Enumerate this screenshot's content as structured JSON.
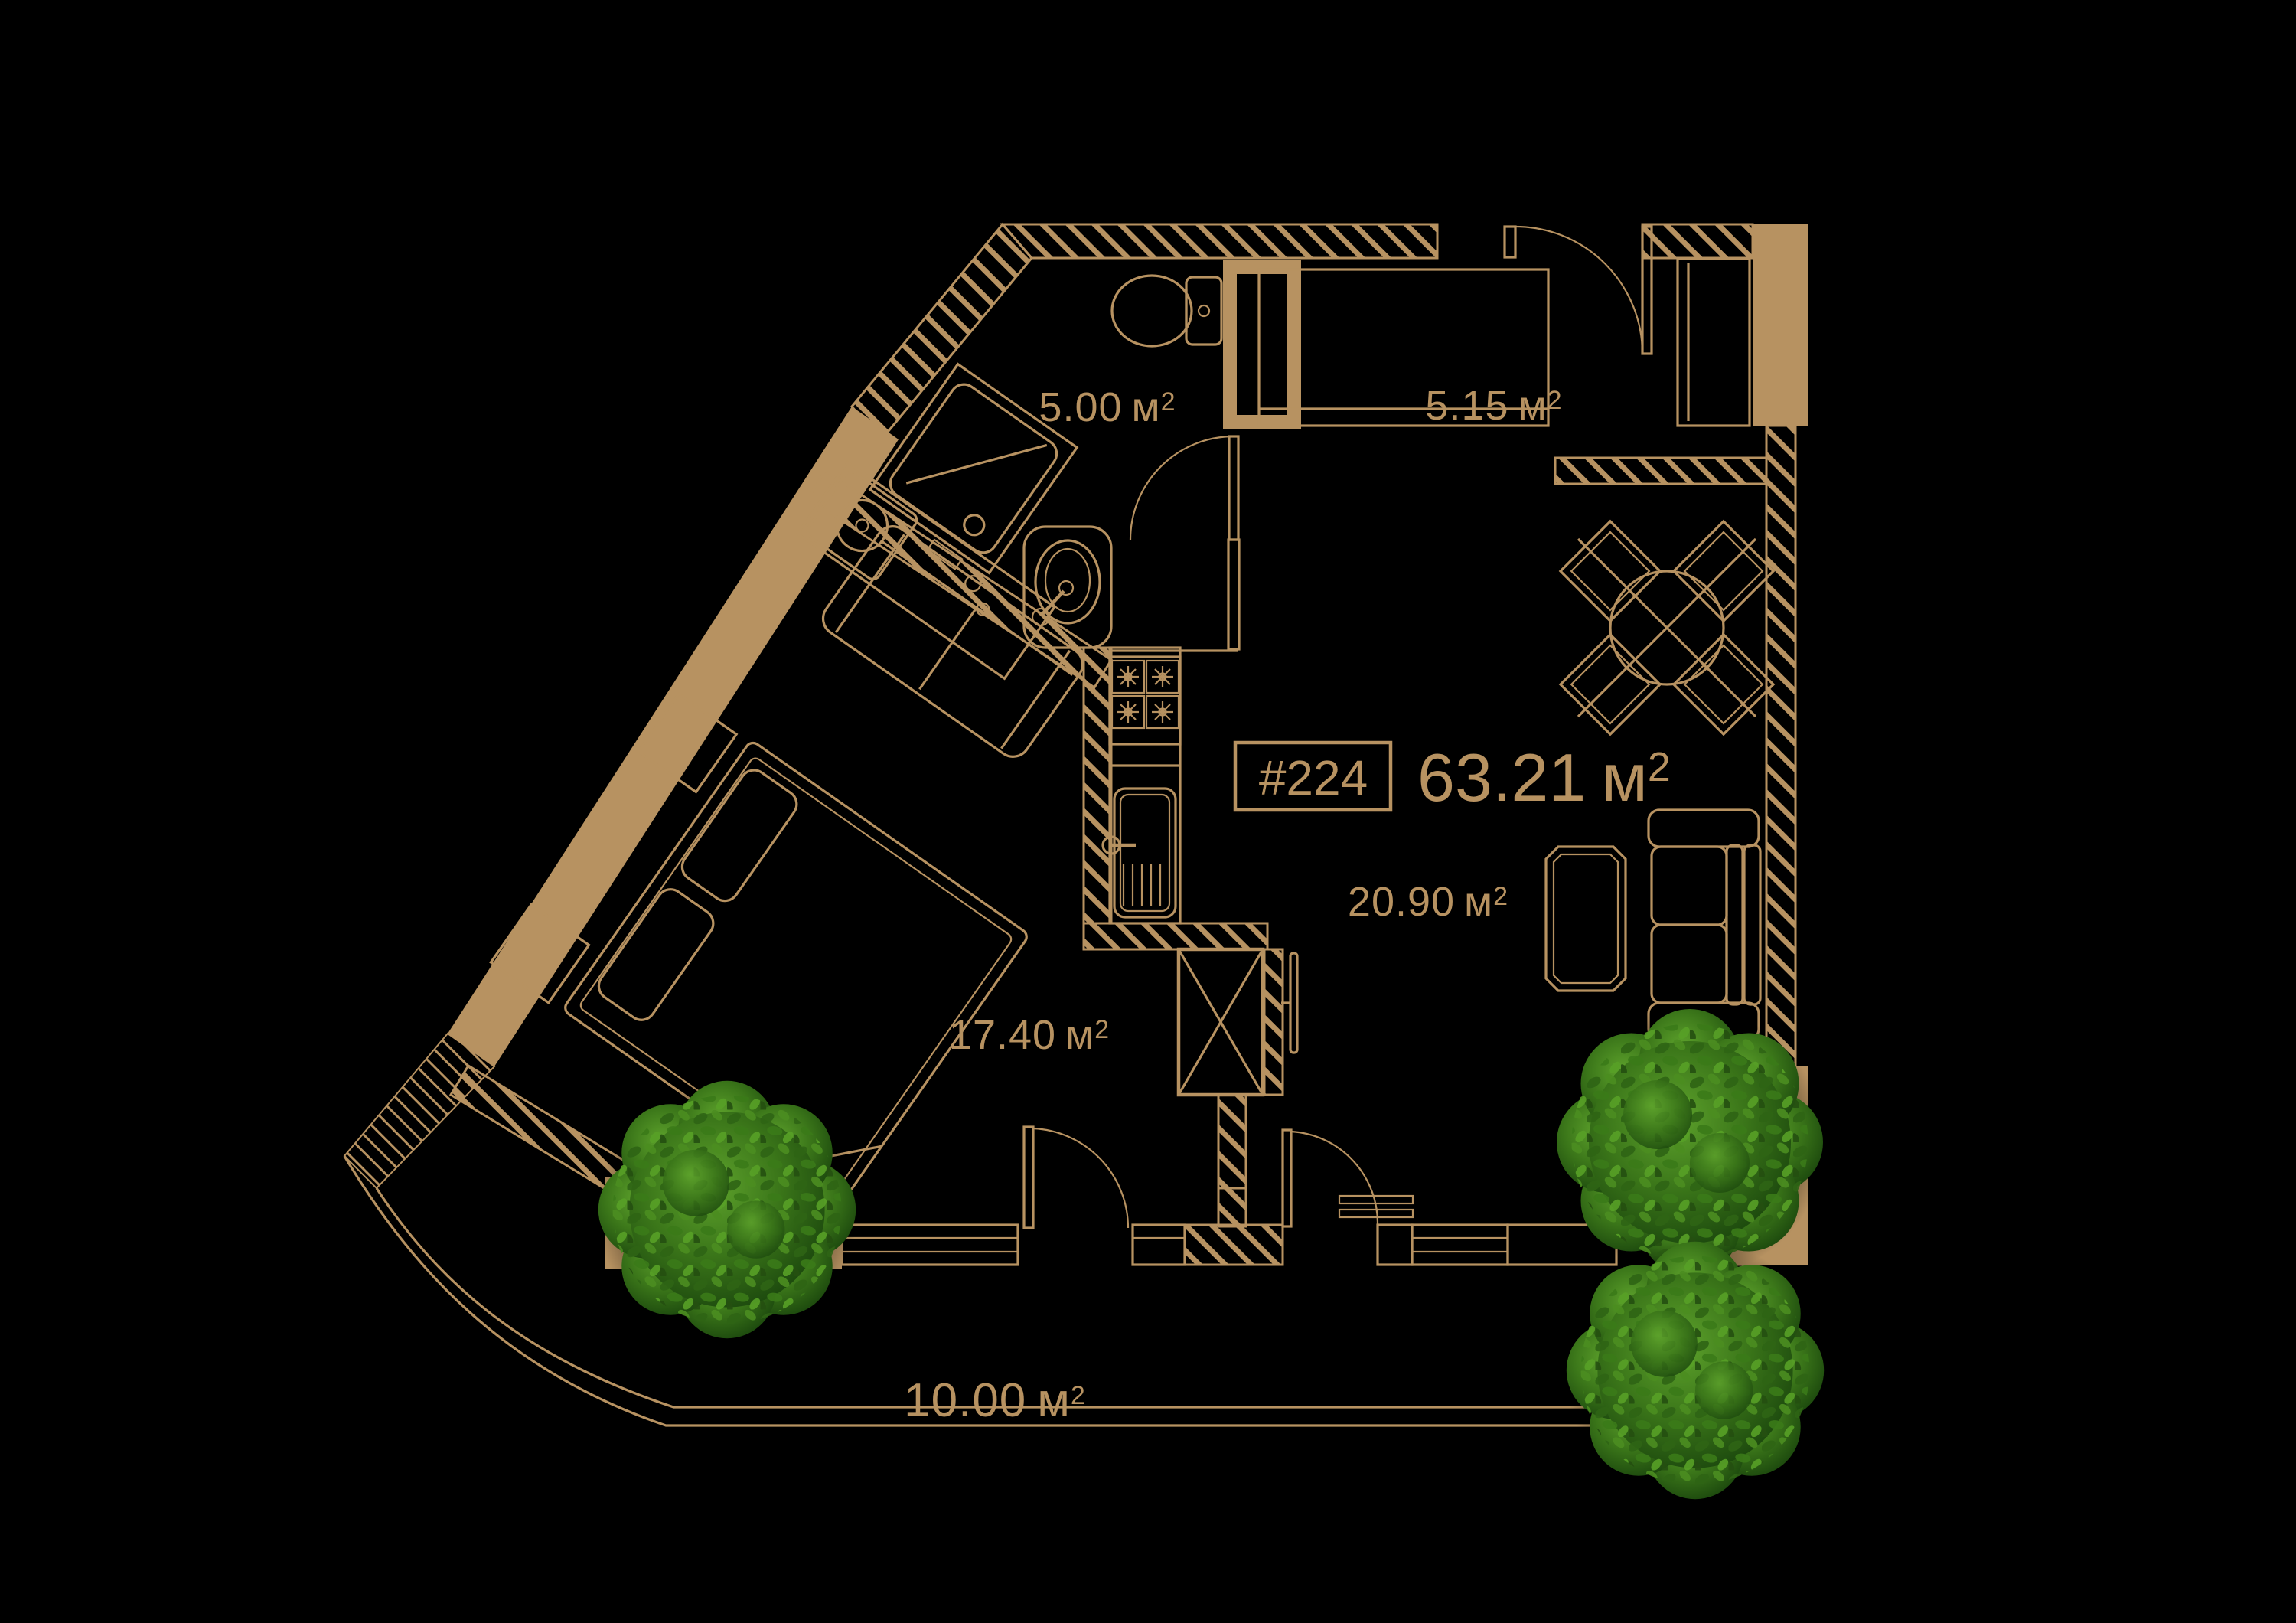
{
  "title": {
    "unit_number": "#224",
    "total_area": "63.21"
  },
  "units": {
    "m": "м",
    "sup": "2"
  },
  "rooms": [
    {
      "name": "bathroom",
      "area": "5.00"
    },
    {
      "name": "hallway",
      "area": "5.15"
    },
    {
      "name": "living-kitchen",
      "area": "20.90"
    },
    {
      "name": "bedroom",
      "area": "17.40"
    },
    {
      "name": "terrace",
      "area": "10.00"
    }
  ],
  "colors": {
    "background": "#000000",
    "plan_line": "#b79261",
    "wall_fill": "#b79261",
    "tree_dark": "#1d4a0e",
    "tree_mid": "#3a7519",
    "tree_light": "#5ea32c"
  },
  "furniture_icons": [
    "shower-icon",
    "washing-machine-icon",
    "vanity-sink-icon",
    "toilet-icon",
    "duct-shaft-icon",
    "wardrobe-icon",
    "closet-icon",
    "stove-icon",
    "kitchen-sink-icon",
    "tall-cabinet-icon",
    "tv-icon",
    "dining-table-icon",
    "chair-icon",
    "sofa-icon",
    "coffee-table-icon",
    "bed-icon",
    "pillow-icon",
    "nightstand-icon",
    "loveseat-icon",
    "door-icon",
    "window-icon",
    "tree-icon"
  ]
}
